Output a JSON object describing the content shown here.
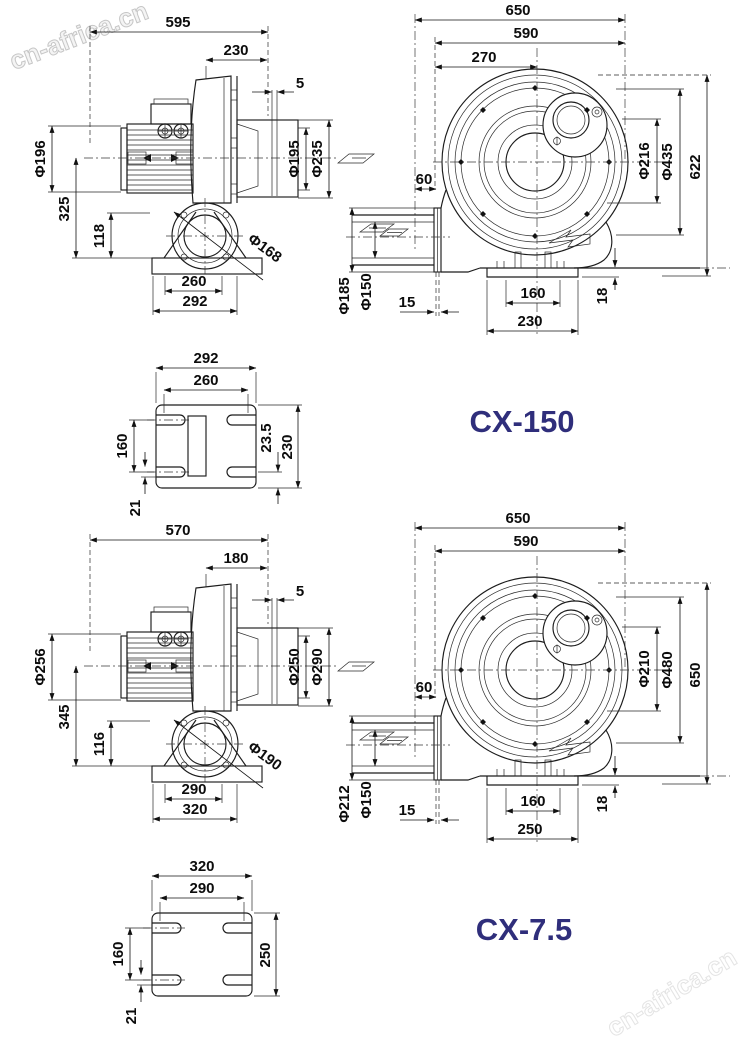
{
  "watermark": {
    "text": "cn-africa.cn"
  },
  "models": [
    {
      "label": "CX-150",
      "side": {
        "overall_width": "595",
        "housing_width": "230",
        "gap": "5",
        "motor_diameter": "Φ196",
        "center_height": "325",
        "base_height": "118",
        "outlet_inner_diameter": "Φ195",
        "outlet_outer_diameter": "Φ235",
        "inlet_diameter": "Φ168",
        "foot_hole_spacing": "260",
        "foot_width": "292"
      },
      "front": {
        "overall_width": "650",
        "body_width": "590",
        "offset_width": "270",
        "duct_length": "60",
        "port_diameter": "Φ216",
        "bolt_circle_diameter": "Φ435",
        "overall_height": "622",
        "flange_diameter": "Φ185",
        "pipe_diameter": "Φ150",
        "flange_offset": "15",
        "foot_slot_spacing": "160",
        "foot_length": "230",
        "base_thickness": "18"
      },
      "base": {
        "width": "292",
        "hole_spacing_x": "260",
        "hole_spacing_y": "160",
        "slot_width": "21",
        "edge_offset": "23.5",
        "depth": "230"
      }
    },
    {
      "label": "CX-7.5",
      "side": {
        "overall_width": "570",
        "housing_width": "180",
        "gap": "5",
        "motor_diameter": "Φ256",
        "center_height": "345",
        "base_height": "116",
        "outlet_inner_diameter": "Φ250",
        "outlet_outer_diameter": "Φ290",
        "inlet_diameter": "Φ190",
        "foot_hole_spacing": "290",
        "foot_width": "320"
      },
      "front": {
        "overall_width": "650",
        "body_width": "590",
        "duct_length": "60",
        "port_diameter": "Φ210",
        "bolt_circle_diameter": "Φ480",
        "overall_height": "650",
        "flange_diameter": "Φ212",
        "pipe_diameter": "Φ150",
        "flange_offset": "15",
        "foot_slot_spacing": "160",
        "foot_length": "250",
        "base_thickness": "18"
      },
      "base": {
        "width": "320",
        "hole_spacing_x": "290",
        "hole_spacing_y": "160",
        "slot_width": "21",
        "depth": "250"
      }
    }
  ],
  "colors": {
    "model_label": "#2f2e7b",
    "line": "#1c1c1c",
    "watermark": "#c9c9c9"
  }
}
